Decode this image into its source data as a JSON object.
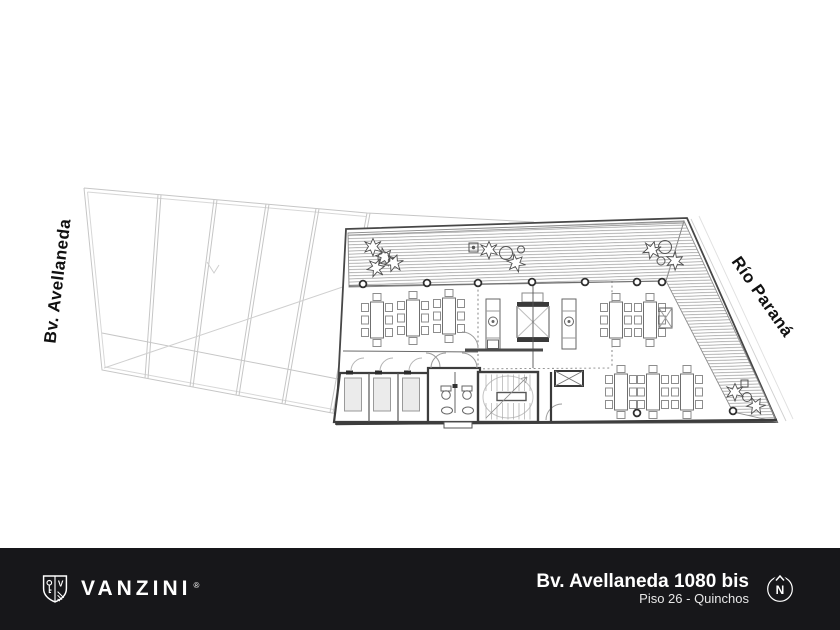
{
  "plan": {
    "street_left": "Bv. Avellaneda",
    "street_right": "Río Paraná"
  },
  "footer": {
    "brand": "VANZINI",
    "registered_mark": "®",
    "monogram": "V",
    "address": "Bv. Avellaneda 1080 bis",
    "floor": "Piso 26 - Quinchos",
    "compass": "N"
  },
  "colors": {
    "background": "#ffffff",
    "footer_background": "#17171a",
    "footer_text": "#ffffff",
    "plan_wall": "#3d3d3d",
    "plan_light": "#c6c6c6",
    "deck_hatch": "#9a9a9a",
    "label_text": "#111111"
  }
}
